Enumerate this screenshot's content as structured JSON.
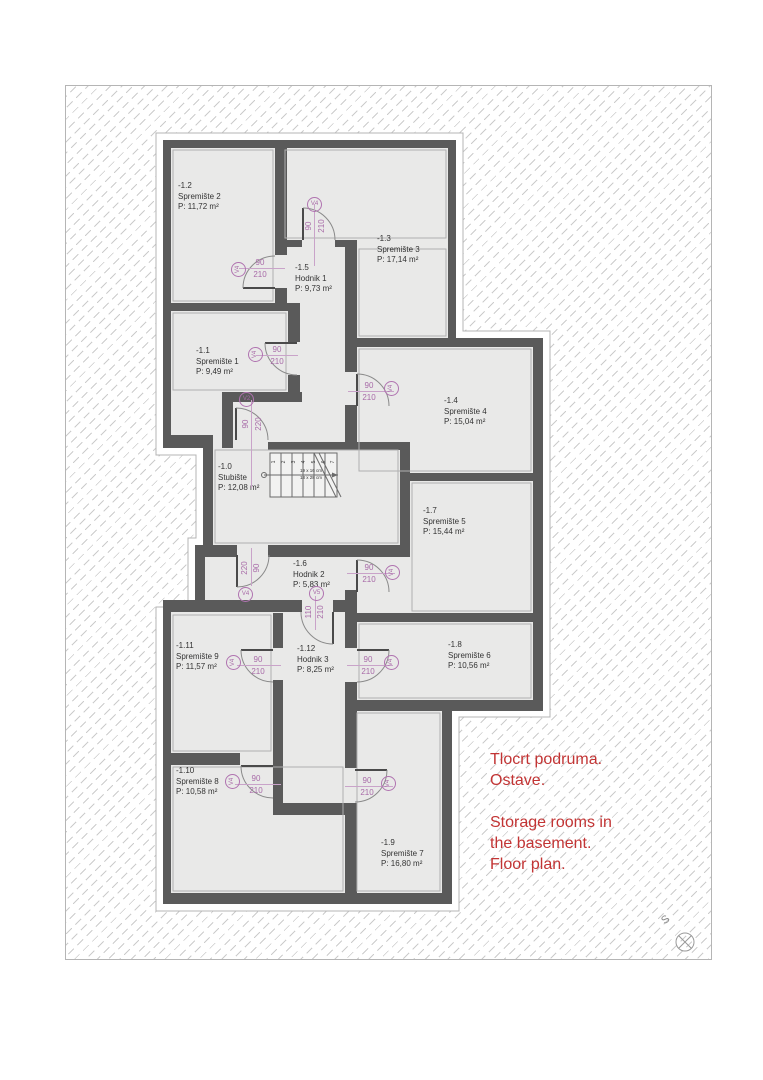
{
  "page": {
    "annotation": {
      "croatian": [
        "Tlocrt podruma.",
        "Ostave."
      ],
      "english": [
        "Storage rooms in",
        "the basement.",
        "Floor plan."
      ]
    },
    "north_letter": "S"
  },
  "rooms": [
    {
      "code": "-1.0",
      "name": "Stubište",
      "area": "P: 12,08 m²"
    },
    {
      "code": "-1.1",
      "name": "Spremište 1",
      "area": "P: 9,49 m²"
    },
    {
      "code": "-1.2",
      "name": "Spremište 2",
      "area": "P: 11,72 m²"
    },
    {
      "code": "-1.3",
      "name": "Spremište 3",
      "area": "P: 17,14 m²"
    },
    {
      "code": "-1.4",
      "name": "Spremište 4",
      "area": "P: 15,04 m²"
    },
    {
      "code": "-1.5",
      "name": "Hodnik 1",
      "area": "P: 9,73 m²"
    },
    {
      "code": "-1.6",
      "name": "Hodnik 2",
      "area": "P: 5,83 m²"
    },
    {
      "code": "-1.7",
      "name": "Spremište 5",
      "area": "P: 15,44 m²"
    },
    {
      "code": "-1.8",
      "name": "Spremište 6",
      "area": "P: 10,56 m²"
    },
    {
      "code": "-1.9",
      "name": "Spremište 7",
      "area": "P: 16,80 m²"
    },
    {
      "code": "-1.10",
      "name": "Spremište 8",
      "area": "P: 10,58 m²"
    },
    {
      "code": "-1.11",
      "name": "Spremište 9",
      "area": "P: 11,57 m²"
    },
    {
      "code": "-1.12",
      "name": "Hodnik 3",
      "area": "P: 8,25 m²"
    }
  ],
  "doors": [
    {
      "label": "V4",
      "d1": "90",
      "d2": "210"
    },
    {
      "label": "V4",
      "d1": "90",
      "d2": "210"
    },
    {
      "label": "V4",
      "d1": "90",
      "d2": "210"
    },
    {
      "label": "V2",
      "d1": "90",
      "d2": "220"
    },
    {
      "label": "V4",
      "d1": "90",
      "d2": "210"
    },
    {
      "label": "V4",
      "d1": "220",
      "d2": "90"
    },
    {
      "label": "V4",
      "d1": "90",
      "d2": "210"
    },
    {
      "label": "V5",
      "d1": "110",
      "d2": "210"
    },
    {
      "label": "V4",
      "d1": "90",
      "d2": "210"
    },
    {
      "label": "V4",
      "d1": "90",
      "d2": "210"
    },
    {
      "label": "V4",
      "d1": "90",
      "d2": "210"
    },
    {
      "label": "V4",
      "d1": "90",
      "d2": "210"
    }
  ],
  "stairs": {
    "dim1": "19 x 16 cm",
    "dim2": "18 x 28 cm",
    "steps": [
      "1",
      "2",
      "3",
      "4",
      "5",
      "6",
      "7"
    ]
  },
  "colors": {
    "wall": "#5a5a5a",
    "floor": "#e9e9e8",
    "dimension_text": "#a86ba8",
    "annotation_text": "#c23434"
  }
}
